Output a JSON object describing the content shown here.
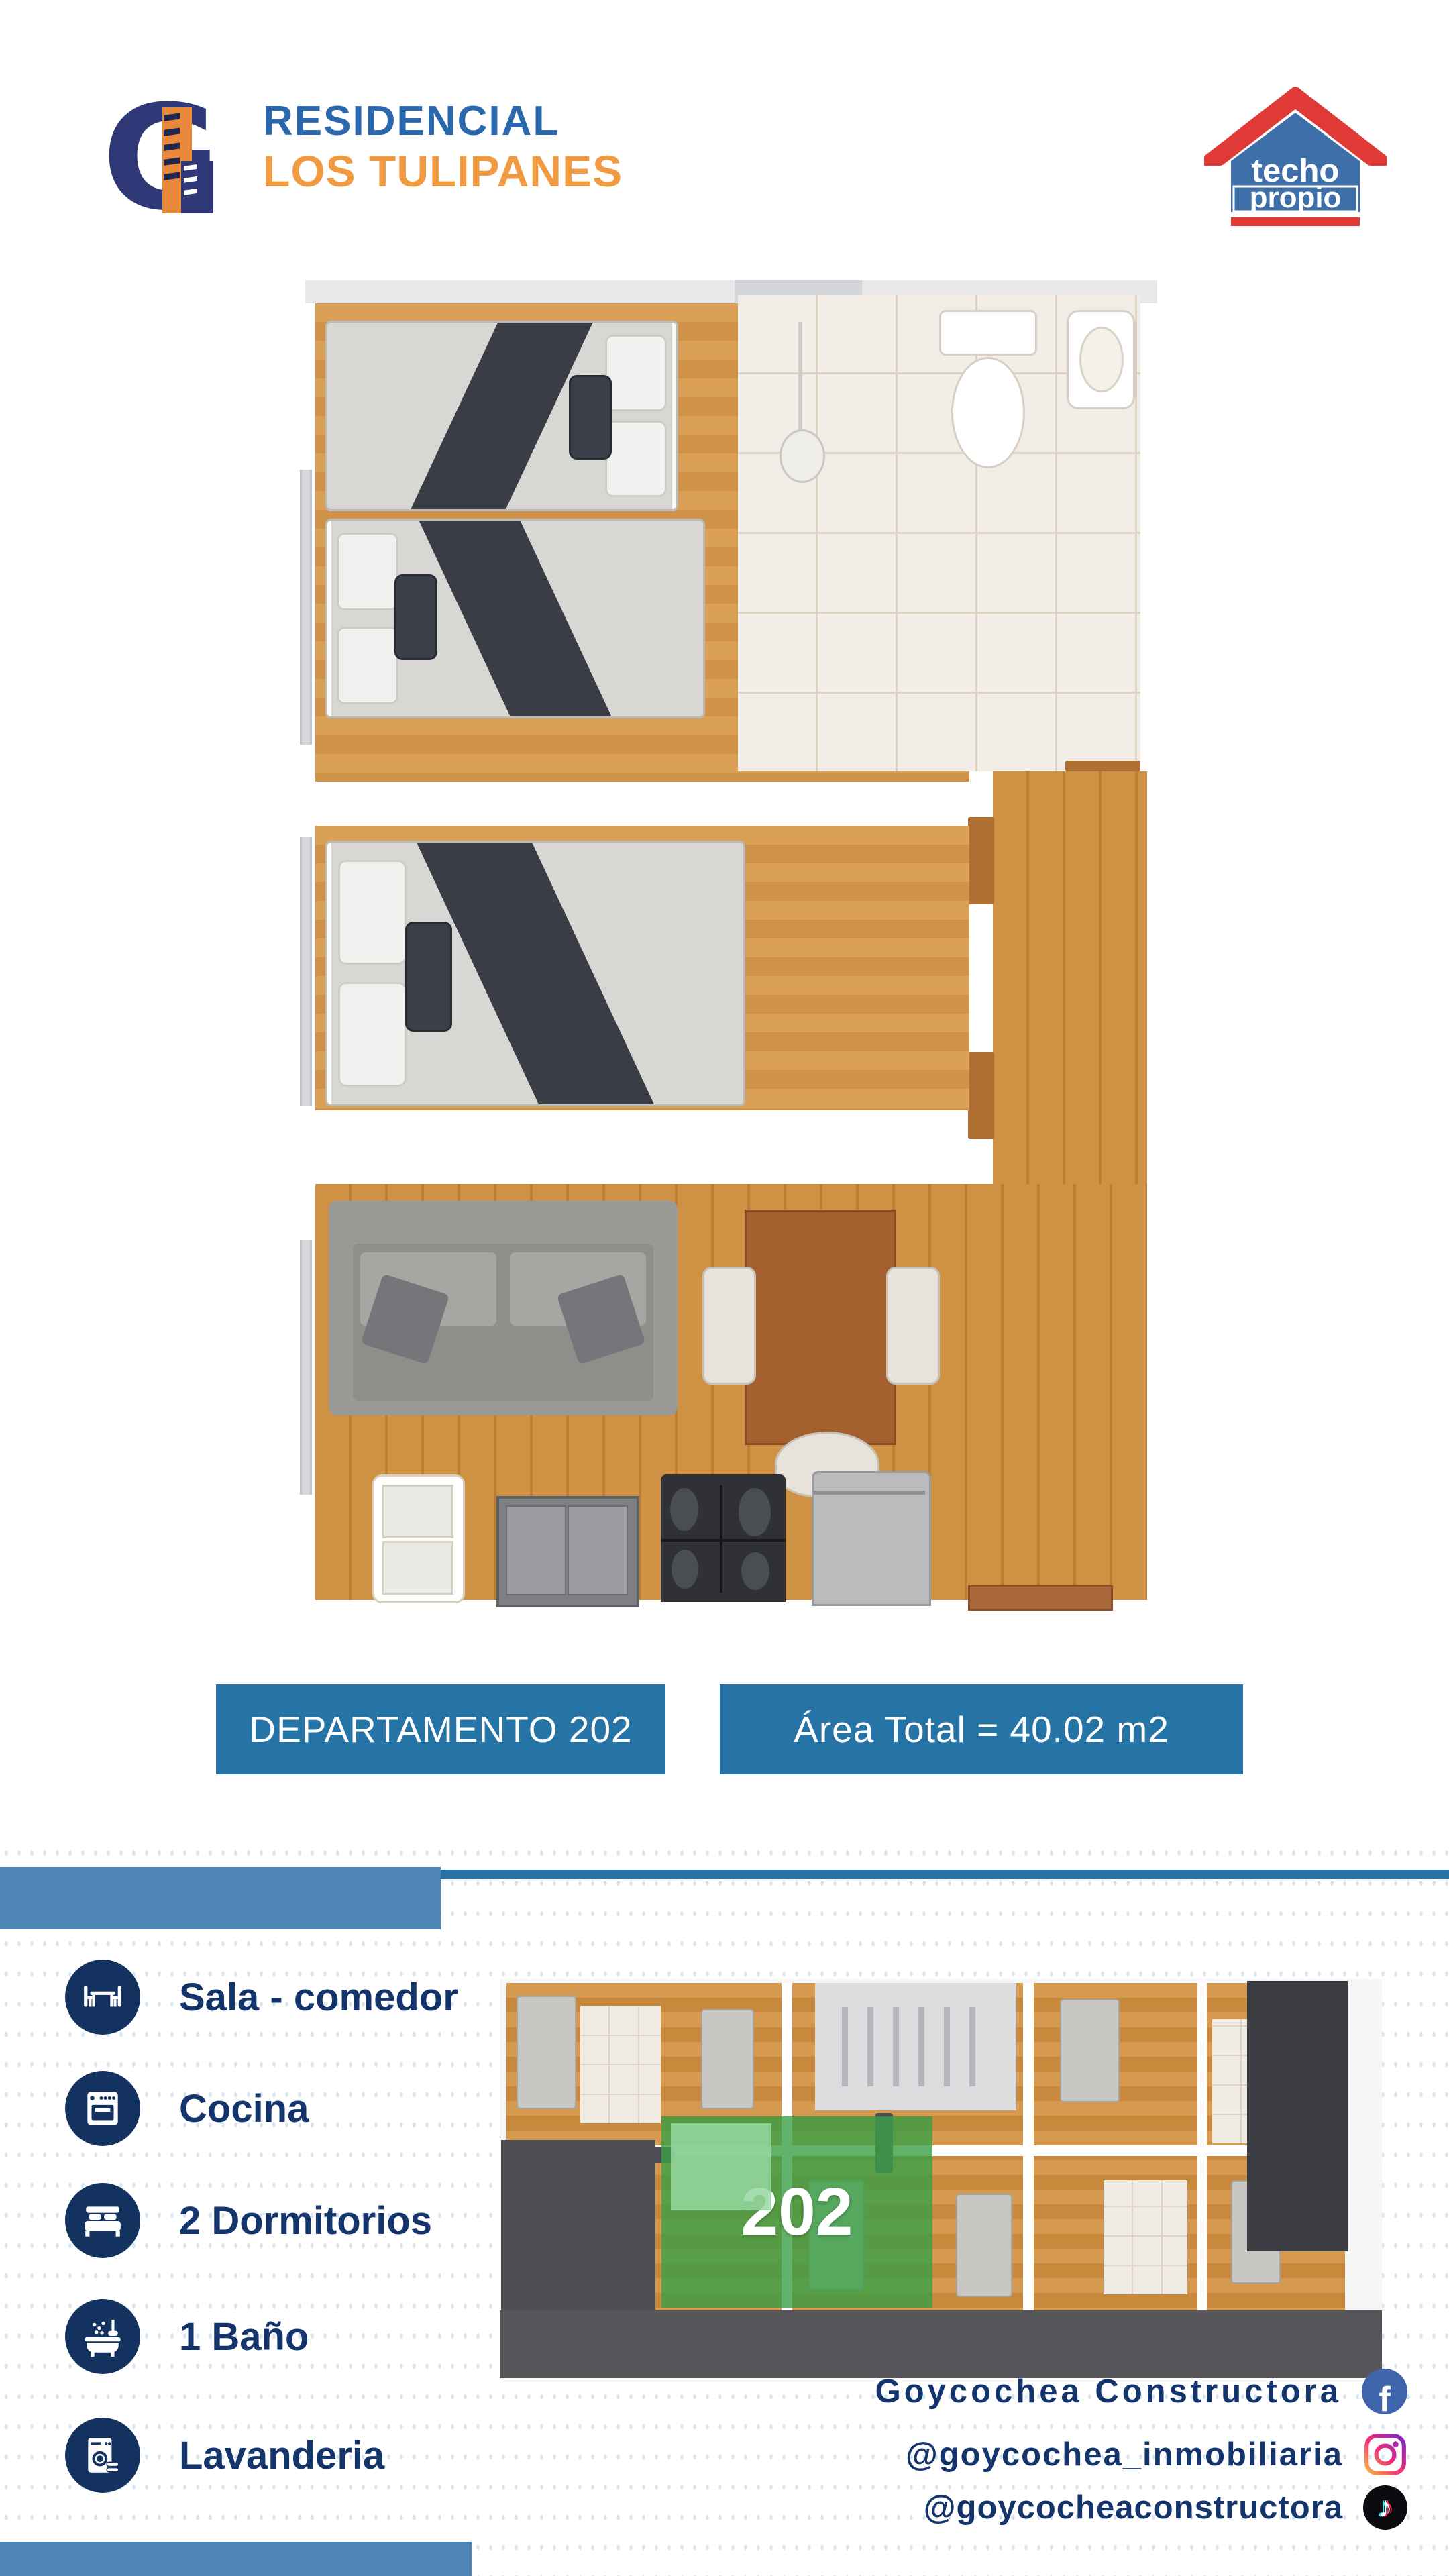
{
  "header": {
    "brand": {
      "monogram": "G",
      "title_line1": "RESIDENCIAL",
      "title_line2": "LOS TULIPANES"
    },
    "program_logo": {
      "word1": "techo",
      "word2": "propio"
    }
  },
  "banners": {
    "unit": "DEPARTAMENTO 202",
    "area": "Área Total =  40.02 m2"
  },
  "amenities": [
    {
      "icon": "dining-table-icon",
      "label": "Sala - comedor"
    },
    {
      "icon": "stove-icon",
      "label": "Cocina"
    },
    {
      "icon": "bed-icon",
      "label": "2 Dormitorios"
    },
    {
      "icon": "bathtub-icon",
      "label": "1 Baño"
    },
    {
      "icon": "washing-machine-icon",
      "label": "Lavanderia"
    }
  ],
  "building_plan": {
    "unit_label": "202"
  },
  "social": {
    "facebook": {
      "label": "Goycochea  Constructora",
      "glyph": "f"
    },
    "instagram": {
      "label": "@goycochea_inmobiliaria"
    },
    "tiktok": {
      "label": "@goycocheaconstructora",
      "glyph": "♪"
    }
  },
  "colors": {
    "banner_blue": "#2673a5",
    "divider_light_blue": "#4d86b4",
    "navy": "#14356b",
    "icon_navy": "#13325f",
    "title_blue": "#2b67ad",
    "title_orange": "#f09a41",
    "dot_blue": "#d7e4f1",
    "highlight_green": "#3aa046",
    "wood_light": "#d59a50",
    "wood_dark": "#bd7e33"
  }
}
